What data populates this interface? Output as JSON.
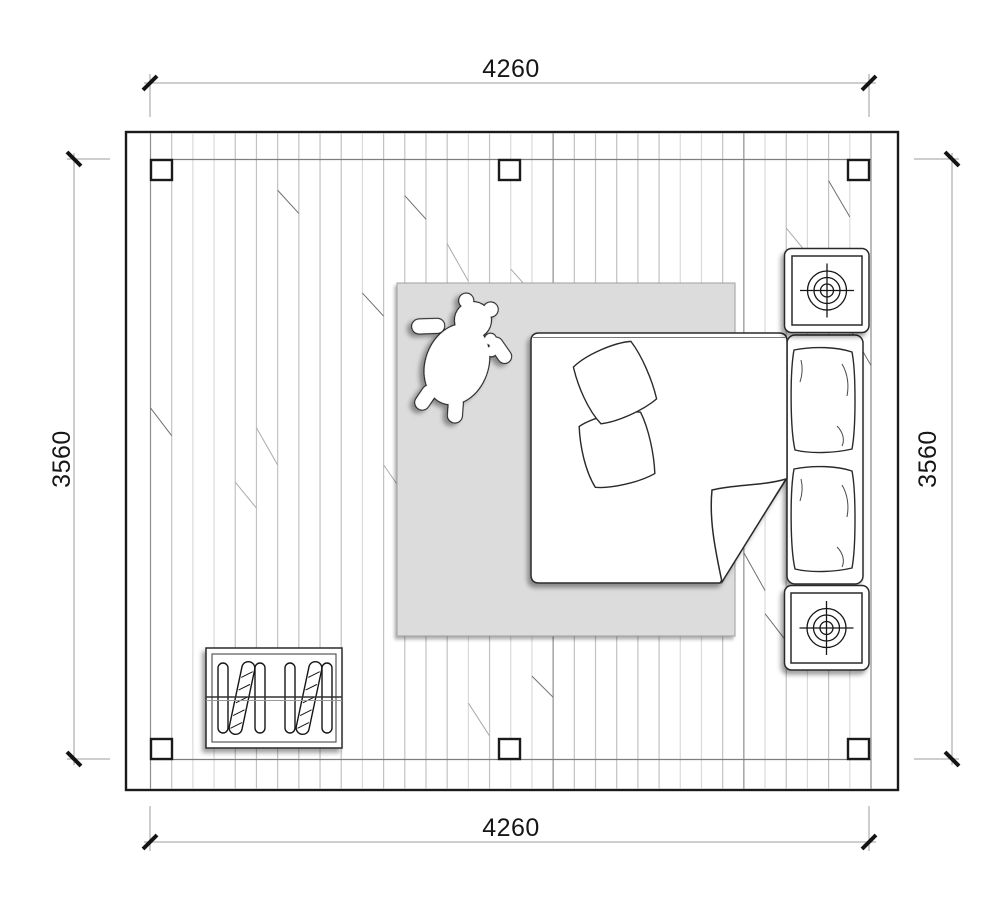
{
  "drawing": {
    "type": "bedroom-floor-plan-top-view",
    "dimensions": {
      "top": "4260",
      "bottom": "4260",
      "left": "3560",
      "right": "3560"
    },
    "items": [
      {
        "name": "double-bed",
        "parts": [
          "duvet",
          "folded-corner",
          "square-pillow",
          "square-pillow",
          "headboard-pillow",
          "headboard-pillow"
        ]
      },
      {
        "name": "nightstand-with-lamp-symbol",
        "count": 2
      },
      {
        "name": "rug"
      },
      {
        "name": "teddy-bear-toy"
      },
      {
        "name": "radiator"
      },
      {
        "name": "structural-column",
        "count": 6
      }
    ],
    "colors": {
      "background": "#ffffff",
      "wall_line": "#1a1a1a",
      "dimension_line": "#9c9c9c",
      "tick": "#141414",
      "rug": "#dcdcdc",
      "plank_light": "#c9c9c9",
      "plank_dark": "#8d8d8d",
      "furniture_line": "#2a2a2a"
    }
  }
}
